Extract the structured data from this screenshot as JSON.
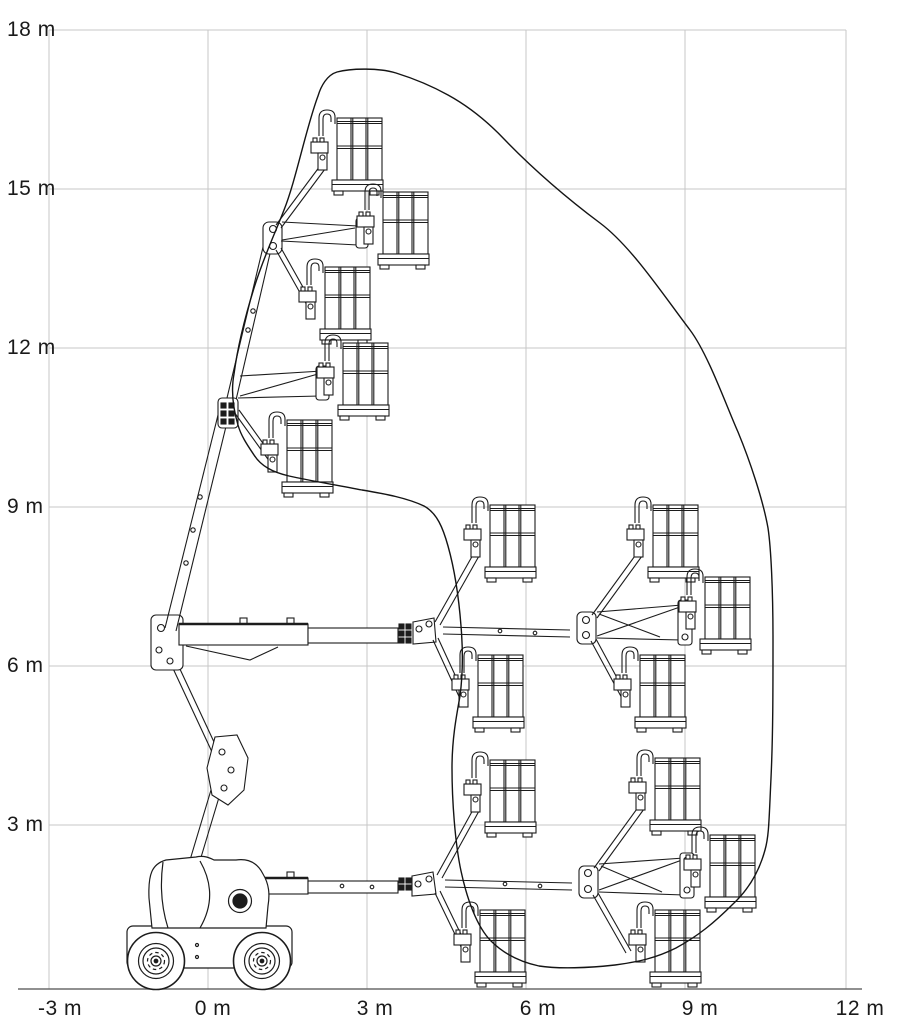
{
  "diagram": {
    "kind": "articulated-boom-lift-working-envelope",
    "background_color": "#ffffff",
    "grid_color": "#c7c7c7",
    "line_color": "#1c1c1c",
    "y_axis": {
      "unit": "m",
      "labels": [
        "18 m",
        "15 m",
        "12 m",
        "9 m",
        "6 m",
        "3 m"
      ],
      "values_m": [
        18,
        15,
        12,
        9,
        6,
        3
      ]
    },
    "x_axis": {
      "unit": "m",
      "labels": [
        "-3 m",
        "0 m",
        "3 m",
        "6 m",
        "9 m",
        "12 m"
      ],
      "values_m": [
        -3,
        0,
        3,
        6,
        9,
        12
      ]
    },
    "scale_px_per_m": 53,
    "envelope": {
      "max_platform_height_m": 17.3,
      "max_outreach_m": 10.7,
      "outline_points_m": [
        [
          0.6,
          10.6
        ],
        [
          0.5,
          11.6
        ],
        [
          1.0,
          13.6
        ],
        [
          1.5,
          15.3
        ],
        [
          2.1,
          16.9
        ],
        [
          2.4,
          17.3
        ],
        [
          3.5,
          17.3
        ],
        [
          4.5,
          16.8
        ],
        [
          5.6,
          16.0
        ],
        [
          7.4,
          14.4
        ],
        [
          9.1,
          12.4
        ],
        [
          10.0,
          10.5
        ],
        [
          10.6,
          8.7
        ],
        [
          10.7,
          6.6
        ],
        [
          10.7,
          4.8
        ],
        [
          10.5,
          2.6
        ],
        [
          9.9,
          1.6
        ],
        [
          8.8,
          0.7
        ],
        [
          7.7,
          0.4
        ],
        [
          6.2,
          0.4
        ],
        [
          5.3,
          0.9
        ],
        [
          4.8,
          2.2
        ],
        [
          4.6,
          4.2
        ],
        [
          4.8,
          5.6
        ],
        [
          4.8,
          7.0
        ],
        [
          4.5,
          8.3
        ],
        [
          4.1,
          9.1
        ],
        [
          2.9,
          9.4
        ],
        [
          1.5,
          9.7
        ],
        [
          0.9,
          10.0
        ]
      ]
    },
    "platform_positions_shown": 15,
    "machine": {
      "type": "4-wheel articulated boom lift, side view",
      "wheel_centers_m": [
        -1.0,
        1.0
      ],
      "boom_configurations_shown": [
        "lowered",
        "mid horizontal",
        "raised telescopic"
      ]
    }
  }
}
